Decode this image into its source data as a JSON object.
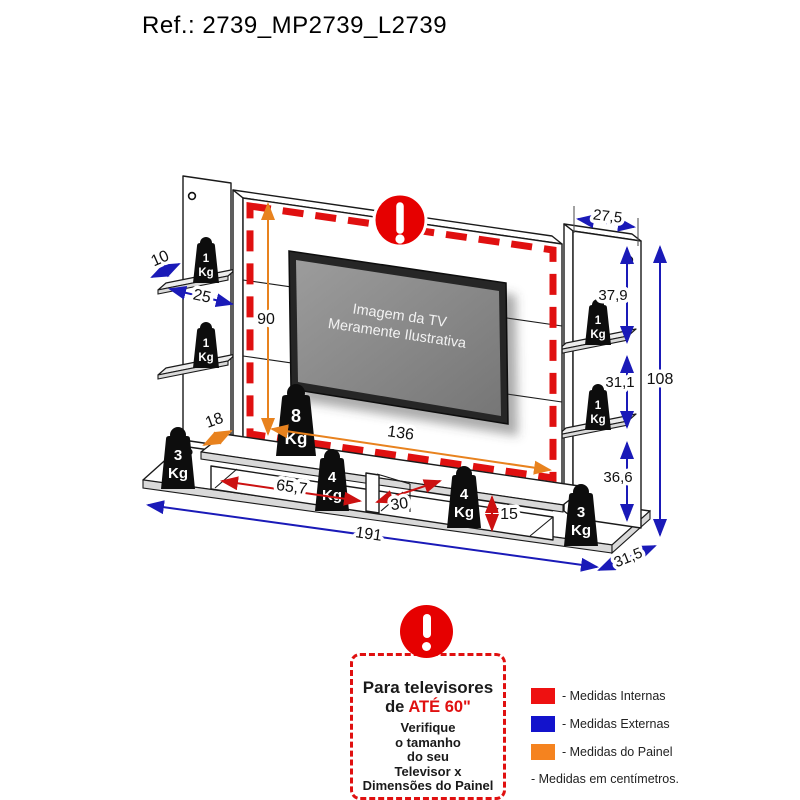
{
  "title": "Ref.: 2739_MP2739_L2739",
  "diagram": {
    "tv_caption": {
      "line1": "Imagem da TV",
      "line2": "Meramente Ilustrativa"
    },
    "dims": {
      "shelf_depth": "10",
      "shelf_width": "25",
      "inner_height": "90",
      "base_side_depth": "18",
      "inner_width": "136",
      "left_compartment_width": "65,7",
      "cable_gap_width": "30",
      "niche_height": "15",
      "total_width": "191",
      "total_depth": "31,5",
      "side_top_depth": "27,5",
      "top_to_shelf": "37,9",
      "between_shelves": "31,1",
      "shelf_to_base": "36,6",
      "total_height": "108"
    },
    "weights": {
      "one": "1",
      "three": "3",
      "four": "4",
      "eight": "8",
      "unit": "Kg"
    }
  },
  "warning_box": {
    "title_line1": "Para televisores",
    "title_line2_prefix": "de",
    "title_line2_highlight": "ATÉ 60\"",
    "body_lines": [
      "Verifique",
      "o tamanho",
      "do seu",
      "Televisor x",
      "Dimensões do Painel"
    ]
  },
  "legend": {
    "items": [
      {
        "label": "- Medidas Internas",
        "color": "#ee1111"
      },
      {
        "label": "- Medidas Externas",
        "color": "#1313cc"
      },
      {
        "label": "- Medidas do Painel",
        "color": "#f5831f"
      }
    ],
    "note": "- Medidas em centímetros."
  },
  "colors": {
    "internal_measure": "#cc1111",
    "external_measure": "#1a1ab8",
    "panel_measure": "#e8821e",
    "warning": "#e60000"
  }
}
